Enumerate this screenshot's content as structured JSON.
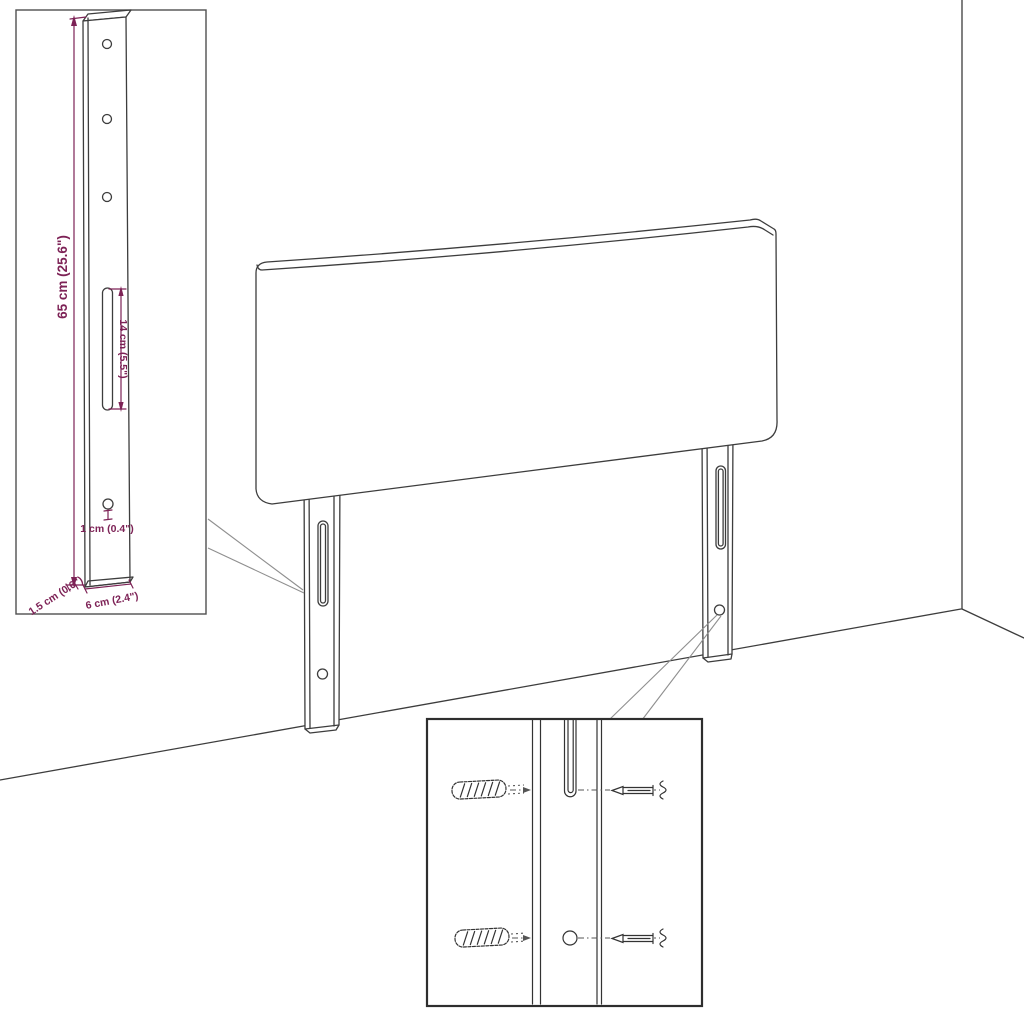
{
  "diagram": {
    "subject": "headboard-with-mounting-legs-assembly-diagram",
    "background": "#ffffff",
    "colors": {
      "outline": "#3d3d3d",
      "dimension_text": "#7d2256",
      "leader_line": "#8f8f8f",
      "inset_border_light": "#4f4f4f",
      "inset_border_dark": "#2e2e2e"
    },
    "leg_detail": {
      "labels": {
        "height": "65 cm (25.6\")",
        "slot_length": "14 cm (5.5\")",
        "hole_diameter": "1 cm (0.4\")",
        "thickness": "1.5 cm (0.6\")",
        "width": "6 cm (2.4\")"
      }
    }
  }
}
